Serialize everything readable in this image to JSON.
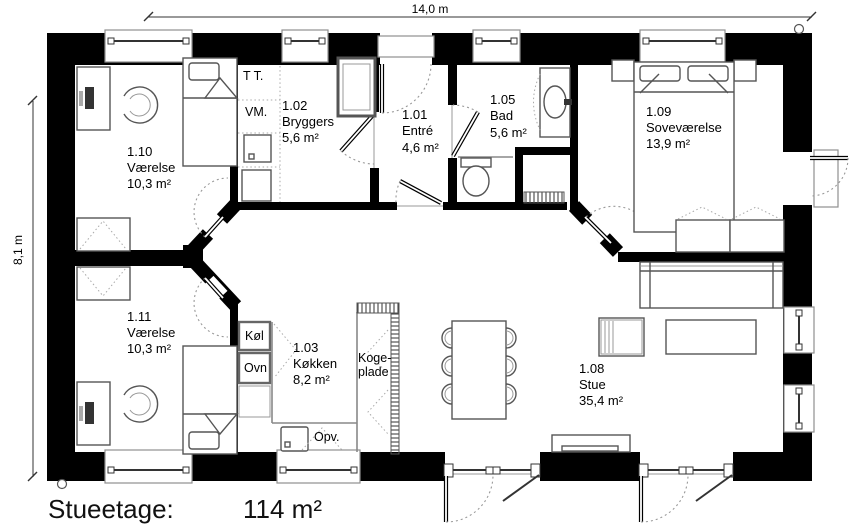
{
  "footer": {
    "floor_label": "Stueetage:",
    "total_area": "114 m²"
  },
  "dimensions": {
    "width_label": "14,0 m",
    "height_label": "8,1 m"
  },
  "rooms": [
    {
      "number": "1.10",
      "name": "Værelse",
      "area": "10,3 m²"
    },
    {
      "number": "1.02",
      "name": "Bryggers",
      "area": "5,6 m²"
    },
    {
      "number": "1.01",
      "name": "Entré",
      "area": "4,6 m²"
    },
    {
      "number": "1.05",
      "name": "Bad",
      "area": "5,6 m²"
    },
    {
      "number": "1.09",
      "name": "Soveværelse",
      "area": "13,9 m²"
    },
    {
      "number": "1.11",
      "name": "Værelse",
      "area": "10,3 m²"
    },
    {
      "number": "1.03",
      "name": "Køkken",
      "area": "8,2 m²"
    },
    {
      "number": "1.08",
      "name": "Stue",
      "area": "35,4 m²"
    }
  ],
  "appliances": {
    "dryer": "T T.",
    "washer": "VM.",
    "fridge": "Køl",
    "oven": "Ovn",
    "dishwasher": "Opv.",
    "cooktop_line1": "Koge-",
    "cooktop_line2": "plade"
  },
  "colors": {
    "wall": "#000000",
    "furniture_outline": "#555555",
    "window_frame": "#8f8f8f",
    "swing_arc": "#999999"
  }
}
